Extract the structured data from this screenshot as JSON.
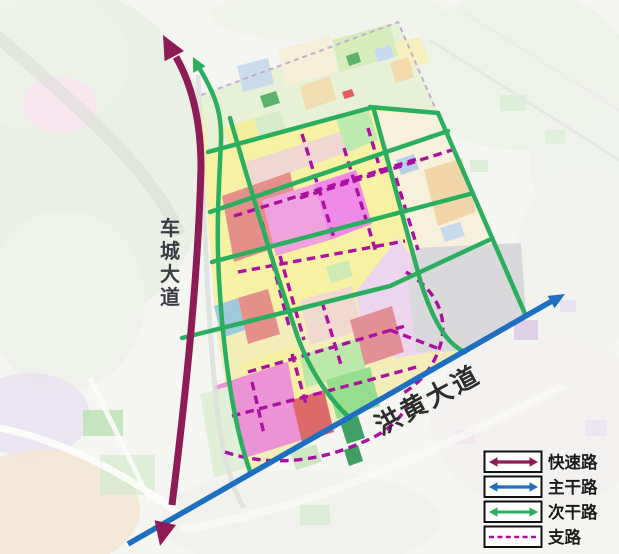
{
  "map": {
    "avenues": {
      "left": {
        "label": "车城大道",
        "chars": [
          "车",
          "城",
          "大",
          "道"
        ]
      },
      "bottom": {
        "label": "洪黄大道"
      }
    }
  },
  "legend": {
    "items": [
      {
        "label": "快速路",
        "symbol": "double-arrow",
        "color": "#8E1B56"
      },
      {
        "label": "主干路",
        "symbol": "double-arrow",
        "color": "#1E6FBF"
      },
      {
        "label": "次干路",
        "symbol": "double-arrow",
        "color": "#2BAE60"
      },
      {
        "label": "支路",
        "symbol": "dashed-line",
        "color": "#AC10A0"
      }
    ]
  },
  "colors": {
    "expressway": "#8E1B56",
    "arterial": "#1E6FBF",
    "secondary": "#2BAE60",
    "branch": "#AC10A0",
    "site_boundary": "#C3AED2"
  }
}
